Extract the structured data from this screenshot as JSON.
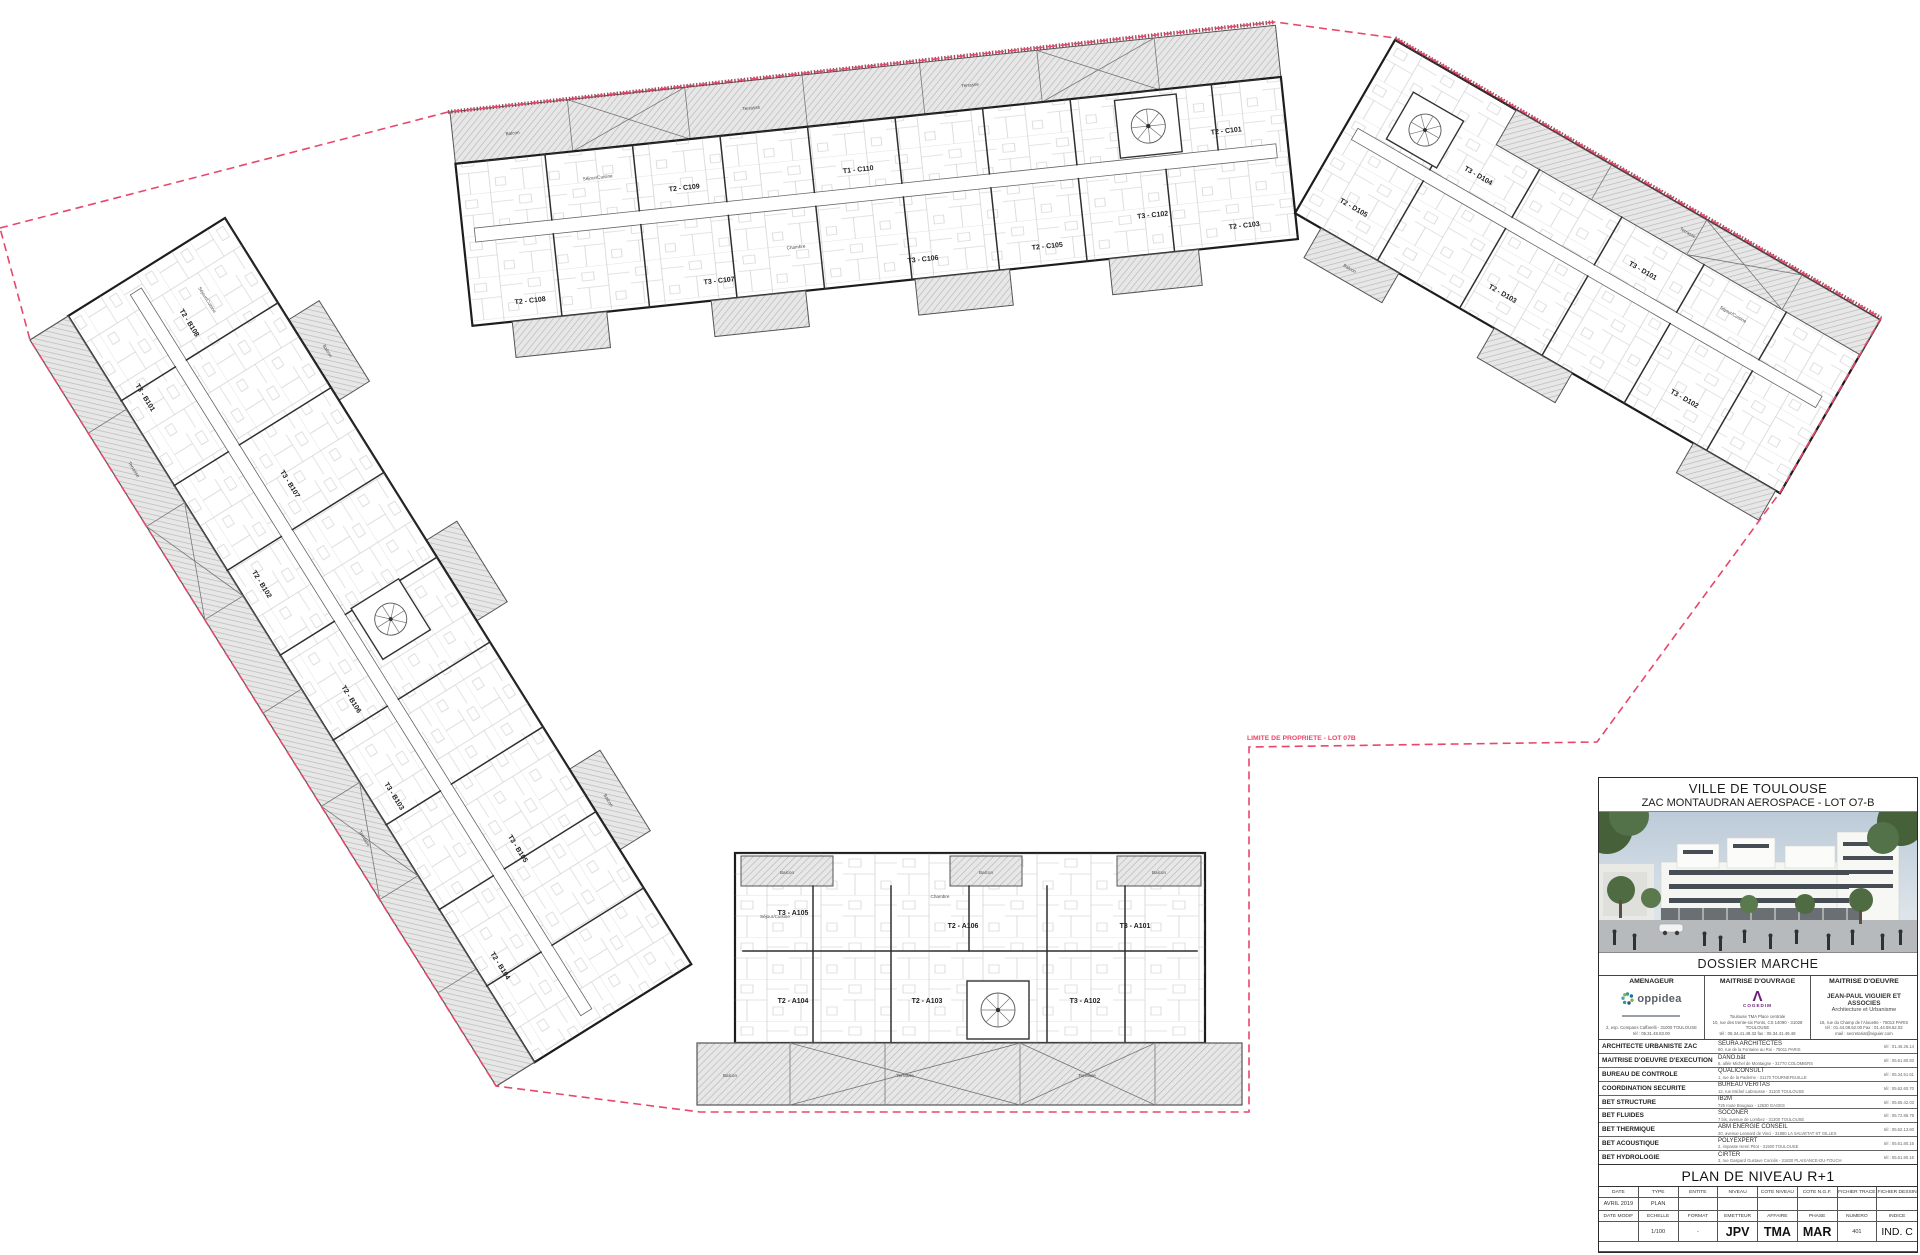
{
  "colors": {
    "boundary_red": "#e8476b",
    "property_edge": "#8a3042",
    "plan_line": "#1c1c1c",
    "hatch_fill": "#e6e6e6"
  },
  "boundary": {
    "label": "LIMITE DE PROPRIETE - LOT 07B"
  },
  "rooms": {
    "sejour": "Séjour/Cuisine",
    "chambre": "Chambre",
    "sdb": "SdB",
    "wc": "WC",
    "entree": "Entrée",
    "balcon": "Balcon",
    "terrasse": "Terrasse"
  },
  "buildings": {
    "c": {
      "units": [
        "T2 - C108",
        "T2 - C109",
        "T1 - C110",
        "T2 - C101",
        "T3 - C107",
        "T3 - C106",
        "T2 - C105",
        "T3 - C102",
        "T2 - C103"
      ]
    },
    "d": {
      "units": [
        "T3 - D104",
        "T3 - D101",
        "T2 - D105",
        "T2 - D103",
        "T3 - D102"
      ]
    },
    "b": {
      "units": [
        "T2 - B108",
        "T3 - B107",
        "T2 - B106",
        "T3 - B105",
        "T3 - B101",
        "T2 - B102",
        "T3 - B103",
        "T2 - B104"
      ]
    },
    "a": {
      "units": [
        "T3 - A105",
        "T2 - A106",
        "T3 - A101",
        "T2 - A104",
        "T2 - A103",
        "T3 - A102"
      ]
    }
  },
  "titleblock": {
    "city": "VILLE DE TOULOUSE",
    "project": "ZAC MONTAUDRAN AEROSPACE - LOT O7-B",
    "dossier": "DOSSIER MARCHE",
    "parties": {
      "amenageur": {
        "header": "AMENAGEUR",
        "logo": "oppidea",
        "address1": "2, esp. Compans Caffarelli - 31000 TOULOUSE",
        "address2": "tél : 05.31.48.83.00"
      },
      "maitrise_ouvrage": {
        "header": "MAITRISE D'OUVRAGE",
        "logo": "COGEDIM",
        "line1": "Toulouse TMA Place centrale",
        "line2": "10, rue des trente-six Ponts, CS 14090 - 31028 TOULOUSE",
        "line3": "tél : 05.34.41.49.32   fax : 05.34.41.49.48"
      },
      "maitrise_oeuvre": {
        "header": "MAITRISE D'OEUVRE",
        "name": "JEAN-PAUL VIGUIER ET ASSOCIES",
        "subtitle": "Architecture et Urbanisme",
        "line1": "16, rue du Champ de l'Alouette - 75013 PARIS",
        "line2": "tél : 01.44.08.62.00   Fax : 01.44.08.62.02",
        "line3": "mail : secretariat@viguier.com"
      }
    },
    "consultants": [
      {
        "role": "ARCHITECTE URBANISTE ZAC",
        "firm": "SEURA ARCHITECTES",
        "address": "90, rue de la Fontaine au Roi - 75011 PARIS",
        "tel": "tél : 01.45.26.14"
      },
      {
        "role": "MAITRISE D'OEUVRE D'EXECUTION",
        "firm": "DANO.bât",
        "address": "6, allée Michel de Montaigne - 31770 COLOMIERS",
        "tel": "tél : 05.61.80.83"
      },
      {
        "role": "BUREAU DE CONTROLE",
        "firm": "QUALICONSULT",
        "address": "1, rue de la Paderne - 31170 TOURNEFEUILLE",
        "tel": "tél : 05.34.51.61"
      },
      {
        "role": "COORDINATION SECURITE",
        "firm": "BUREAU VERITAS",
        "address": "12, rue Michel Labrousse - 31100 TOULOUSE",
        "tel": "tél : 05.62.60.70"
      },
      {
        "role": "BET STRUCTURE",
        "firm": "IB2M",
        "address": "725 route Bougaux - 12630 GAGES",
        "tel": "tél : 05.65.42.03"
      },
      {
        "role": "BET FLUIDES",
        "firm": "SOCONER",
        "address": "7 bis, avenue de Lombez - 31300 TOULOUSE",
        "tel": "tél : 05.72.86.78"
      },
      {
        "role": "BET THERMIQUE",
        "firm": "ABM ENERGIE CONSEIL",
        "address": "20, avenue Leonard de Vinci - 31880 LA SALVETAT ST GILLES",
        "tel": "tél : 05.62.13.60"
      },
      {
        "role": "BET ACOUSTIQUE",
        "firm": "POLYEXPERT",
        "address": "2, impasse Henri Pitot - 31500 TOULOUSE",
        "tel": "tél : 05.61.80.16"
      },
      {
        "role": "BET HYDROLOGIE",
        "firm": "CIRTER",
        "address": "3, rue Gaspard Gustave Coriolis - 31830 PLAISANCE-DU-TOUCH",
        "tel": "tél : 05.61.80.16"
      }
    ],
    "plan_title": "PLAN DE NIVEAU R+1",
    "grid": {
      "headers1": [
        "DATE",
        "TYPE",
        "ENTITE",
        "NIVEAU",
        "COTE NIVEAU",
        "COTE N.G.F.",
        "FICHIER TRACE",
        "FICHIER DESSIN"
      ],
      "values1": [
        "AVRIL 2019",
        "PLAN",
        "",
        "",
        "",
        "",
        "",
        ""
      ],
      "headers2": [
        "DATE MODIF",
        "ECHELLE",
        "FORMAT",
        "EMETTEUR",
        "AFFAIRE",
        "PHASE",
        "NUMERO",
        "INDICE"
      ],
      "values2": [
        "",
        "1/100",
        "-",
        "JPV",
        "TMA",
        "MAR",
        "401",
        "IND. C"
      ]
    }
  }
}
